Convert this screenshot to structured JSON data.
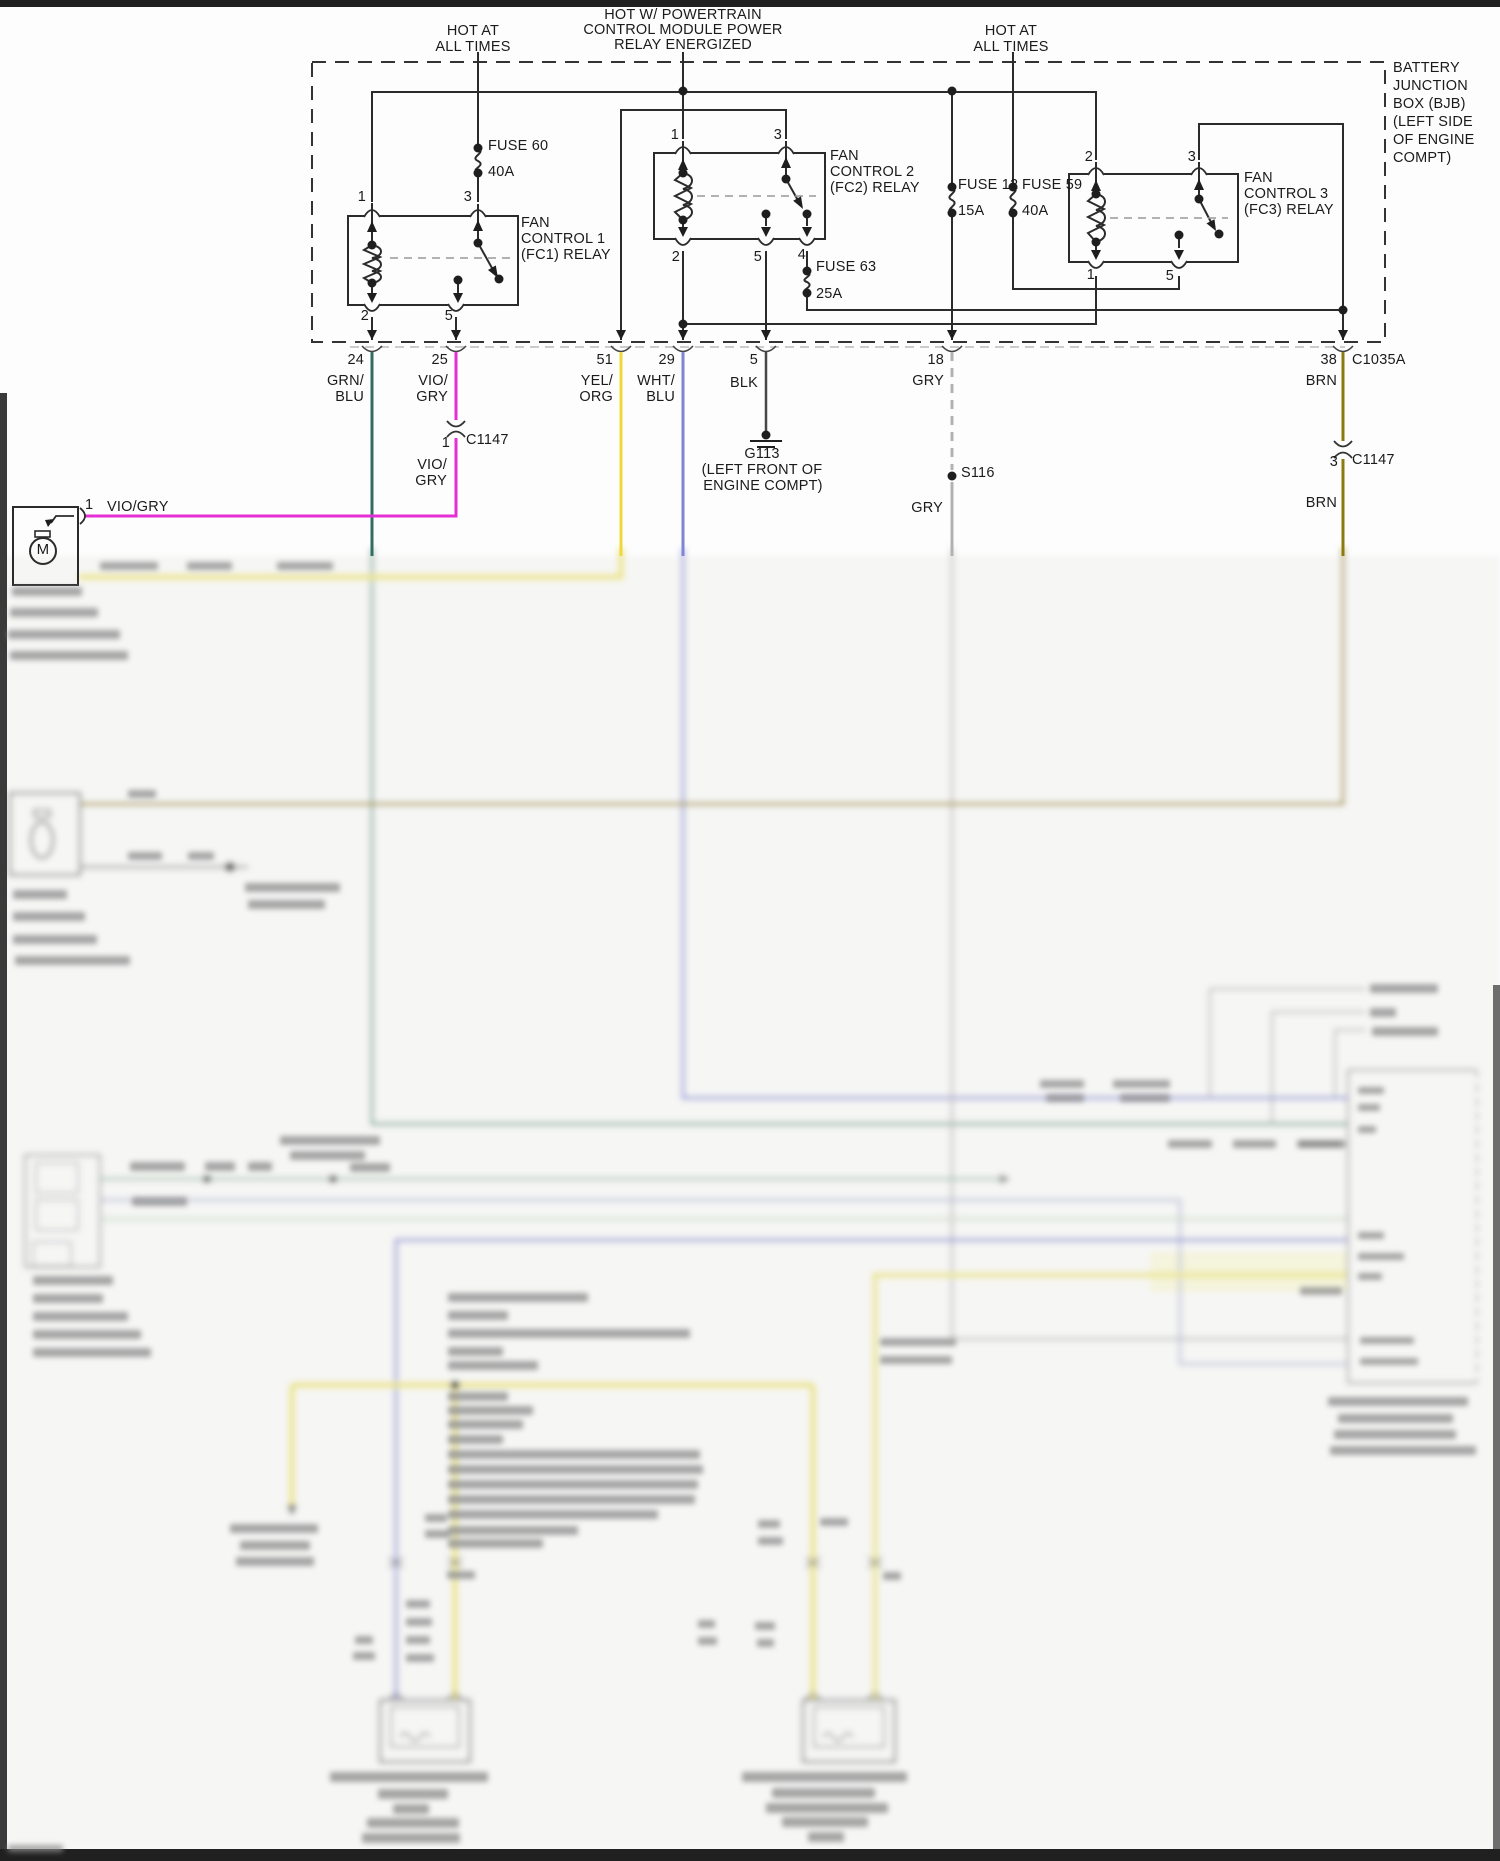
{
  "title": "Engine Cooling Fan Wiring Diagram",
  "labels": {
    "hot_left": [
      "HOT AT",
      "ALL TIMES"
    ],
    "pcm": [
      "HOT W/ POWERTRAIN",
      "CONTROL MODULE POWER",
      "RELAY ENERGIZED"
    ],
    "hot_right": [
      "HOT AT",
      "ALL TIMES"
    ],
    "bjb": [
      "BATTERY",
      "JUNCTION",
      "BOX (BJB)",
      "(LEFT SIDE",
      "OF ENGINE",
      "COMPT)"
    ],
    "fuses": {
      "f60": {
        "name": "FUSE 60",
        "rating": "40A"
      },
      "f12": {
        "name": "FUSE 12",
        "rating": "15A"
      },
      "f59": {
        "name": "FUSE 59",
        "rating": "40A"
      },
      "f63": {
        "name": "FUSE 63",
        "rating": "25A"
      }
    },
    "relays": {
      "fc1": {
        "name": [
          "FAN",
          "CONTROL 1",
          "(FC1) RELAY"
        ],
        "pins": {
          "t1": "1",
          "t2": "3",
          "b1": "2",
          "b2": "5"
        }
      },
      "fc2": {
        "name": [
          "FAN",
          "CONTROL 2",
          "(FC2) RELAY"
        ],
        "pins": {
          "t1": "1",
          "t2": "3",
          "b1": "2",
          "b2": "5",
          "b3": "4"
        }
      },
      "fc3": {
        "name": [
          "FAN",
          "CONTROL 3",
          "(FC3) RELAY"
        ],
        "pins": {
          "t1": "2",
          "t2": "3",
          "b1": "1",
          "b2": "5"
        }
      }
    },
    "wires": {
      "w24": {
        "num": "24",
        "c1": "GRN/",
        "c2": "BLU"
      },
      "w25": {
        "num": "25",
        "c1": "VIO/",
        "c2": "GRY"
      },
      "w51": {
        "num": "51",
        "c1": "YEL/",
        "c2": "ORG"
      },
      "w29": {
        "num": "29",
        "c1": "WHT/",
        "c2": "BLU"
      },
      "w5": {
        "num": "5",
        "c1": "BLK"
      },
      "w18": {
        "num": "18",
        "c1": "GRY"
      },
      "w38": {
        "num": "38",
        "c1": "BRN"
      }
    },
    "connectors": {
      "c1035a": "C1035A",
      "c1147_left": {
        "pin": "1",
        "name": "C1147",
        "color1": "VIO/",
        "color2": "GRY"
      },
      "c1147_right": {
        "pin": "3",
        "name": "C1147",
        "color_below": "BRN"
      }
    },
    "ground": {
      "name": "G113",
      "loc1": "(LEFT FRONT OF",
      "loc2": "ENGINE COMPT)"
    },
    "splice": {
      "name": "S116",
      "color_below": "GRY"
    },
    "motor": {
      "sym": "M",
      "pin": "1",
      "wire": "VIO/GRY"
    }
  },
  "colors": {
    "line": "#2b2b2b",
    "vio_gry": "#e62ed6",
    "grn_blu": "#2f6e60",
    "yel_org": "#eed93a",
    "wht_blu": "#8083d6",
    "blk": "#474747",
    "gry": "#b2b2b2",
    "brn": "#8c7a10"
  }
}
